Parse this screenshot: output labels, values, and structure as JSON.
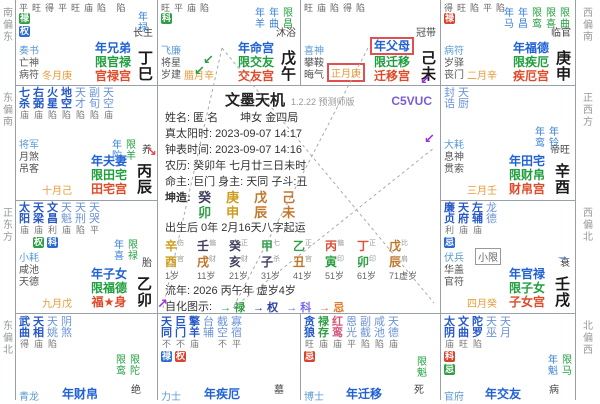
{
  "colors": {
    "main_star": "#2458c8",
    "minor_star": "#6b93d6",
    "lucun_green": "#2f9e44",
    "badge_birth": "#d9432b",
    "badge_decade": "#2f9e44",
    "badge_flow": "#2a6bd4",
    "year_name": "#2061d6",
    "limit_name": "#1f9e3e",
    "natal_name": "#e04a28",
    "month_orange": "#e89a35",
    "highlight_box": "#e05050",
    "code_purple": "#7a5cd6"
  },
  "compass": {
    "left": [
      "南偏东",
      "东偏南",
      "正东方",
      "东偏北"
    ],
    "right": [
      "西偏南",
      "正西方",
      "西偏北",
      "北偏西"
    ]
  },
  "center": {
    "title": "文墨天机",
    "version": "1.2.22 预测师版",
    "code": "C5VUC",
    "lines": {
      "name": "姓名: 匿 名　　坤女 金四局",
      "true_solar": "真太阳时: 2023-09-07 14:17",
      "clock_time": "钟表时间: 2023-09-07 14:16",
      "lunar": "农历: 癸卯年 七月廿三日未时",
      "lords": "命主: 巨门 身主: 天同 子斗:丑",
      "bazi_label": "坤造:",
      "qiyun": "出生后 0年 2月16天八字起运",
      "liunian": "流年: 2026 丙午年 虚岁4岁",
      "zihua_label": "自化图示:"
    },
    "bazi": [
      {
        "stem": "癸",
        "branch": "卯",
        "stem_el": "water",
        "branch_el": "wood"
      },
      {
        "stem": "庚",
        "branch": "申",
        "stem_el": "metal",
        "branch_el": "metal"
      },
      {
        "stem": "戊",
        "branch": "辰",
        "stem_el": "earth",
        "branch_el": "earth"
      },
      {
        "stem": "己",
        "branch": "未",
        "stem_el": "earth",
        "branch_el": "earth"
      }
    ],
    "dayun": [
      {
        "stem": "辛",
        "branch": "酉",
        "god": "伤官",
        "age": "1岁",
        "stem_el": "metal",
        "branch_el": "metal"
      },
      {
        "stem": "壬",
        "branch": "戌",
        "god": "偏财",
        "age": "11岁",
        "stem_el": "water",
        "branch_el": "earth"
      },
      {
        "stem": "癸",
        "branch": "亥",
        "god": "正财",
        "age": "21岁",
        "stem_el": "water",
        "branch_el": "water"
      },
      {
        "stem": "甲",
        "branch": "子",
        "god": "七杀",
        "age": "31岁",
        "stem_el": "wood",
        "branch_el": "water"
      },
      {
        "stem": "乙",
        "branch": "丑",
        "god": "正官",
        "age": "41岁",
        "stem_el": "wood",
        "branch_el": "earth"
      },
      {
        "stem": "丙",
        "branch": "寅",
        "god": "偏印",
        "age": "51岁",
        "stem_el": "fire",
        "branch_el": "wood"
      },
      {
        "stem": "丁",
        "branch": "卯",
        "god": "正印",
        "age": "61岁",
        "stem_el": "fire",
        "branch_el": "wood"
      },
      {
        "stem": "戊",
        "branch": "辰",
        "god": "比肩",
        "age": "71虚岁",
        "stem_el": "earth",
        "branch_el": "earth"
      }
    ],
    "zihua": [
      {
        "label": "→ 禄",
        "color": "#2f9e44"
      },
      {
        "label": "→ 权",
        "color": "#2c3ea0"
      },
      {
        "label": "→ 科",
        "color": "#7b68ee"
      },
      {
        "label": "→ 忌",
        "color": "#e07a2c"
      }
    ]
  },
  "palaces": {
    "si": {
      "branch": "巳",
      "stem": "丁巳",
      "stage": "长生",
      "month": "冬月庚",
      "gods": [
        "奏书",
        "亡神",
        "病符"
      ],
      "names": [
        "年兄弟",
        "限官禄",
        "官禄宫"
      ],
      "bri": "平旺得平旺庙陷 陷",
      "badges": [
        [
          "禄",
          "d"
        ],
        [
          "权",
          "f"
        ]
      ],
      "flows": [
        [
          "年禄",
          "year"
        ]
      ]
    },
    "wu": {
      "branch": "午",
      "stem": "戊午",
      "stage": "沐浴",
      "month": "腊月辛",
      "gods": [
        "飞廉",
        "将星",
        "岁建"
      ],
      "names": [
        "年命宫",
        "限交友",
        "交友宫"
      ],
      "bri": "旺平庙陷",
      "badges": [
        [
          "科",
          "d"
        ]
      ],
      "flows": [
        [
          "年羊",
          "year"
        ],
        [
          "年曲",
          "year"
        ],
        [
          "限昌",
          "limit"
        ]
      ]
    },
    "wei": {
      "branch": "未",
      "stem": "己未",
      "stage": "冠带",
      "month": "正月庚",
      "month_boxed": true,
      "gods": [
        "喜神",
        "攀鞍",
        "晦气"
      ],
      "names": [
        "年父母",
        "限迁移",
        "迁移宫"
      ],
      "name_boxed": true,
      "bri": "旺庙陷得陷",
      "badges": [],
      "flows": []
    },
    "shen": {
      "branch": "申",
      "stem": "庚申",
      "stage": "临官",
      "month": "二月辛",
      "gods": [
        "病符",
        "岁驿",
        "丧门"
      ],
      "names": [
        "年福德",
        "限疾厄",
        "疾厄宫"
      ],
      "bri": "得旺陷平陷",
      "badges": [
        [
          "禄",
          "y"
        ]
      ],
      "flows": [
        [
          "年马",
          "year"
        ],
        [
          "年昌",
          "year"
        ],
        [
          "限鸾",
          "limit"
        ],
        [
          "限喜",
          "limit"
        ],
        [
          "限曲",
          "limit"
        ]
      ]
    },
    "you": {
      "branch": "酉",
      "stem": "辛酉",
      "stage": "帝旺",
      "month": "三月壬",
      "gods": [
        "大耗",
        "息神",
        "贯索"
      ],
      "names": [
        "年田宅",
        "限财帛",
        "财帛宫"
      ],
      "stars": [
        {
          "n": "封诰",
          "b": "",
          "c": "mi"
        },
        {
          "n": "天厨",
          "b": "",
          "c": "mi"
        }
      ],
      "flows": [
        [
          "年鸾",
          "year"
        ],
        [
          "年铃",
          "year"
        ]
      ]
    },
    "xu": {
      "branch": "戌",
      "stem": "壬戌",
      "stage": "衰",
      "month": "四月癸",
      "gods": [
        "伏兵",
        "华盖",
        "官符"
      ],
      "names": [
        "年官禄",
        "限子女",
        "子女宫"
      ],
      "stars": [
        {
          "n": "廉贞",
          "b": "利",
          "c": "m",
          "bd": [
            [
              "忌",
              "f"
            ]
          ]
        },
        {
          "n": "天府",
          "b": "庙",
          "c": "m"
        },
        {
          "n": "左辅",
          "b": "庙",
          "c": "m"
        },
        {
          "n": "龙德",
          "b": "",
          "c": "mi"
        }
      ],
      "xiaoxian": "小限",
      "flows": []
    },
    "hai": {
      "branch": "亥",
      "stage": "病",
      "gods": [
        "官府"
      ],
      "names": [
        "年交友"
      ],
      "stars": [
        {
          "n": "太阴",
          "b": "庙",
          "c": "m",
          "bd": [
            [
              "科",
              "y"
            ],
            [
              "忌",
              "d"
            ]
          ]
        },
        {
          "n": "文曲",
          "b": "旺",
          "c": "m"
        },
        {
          "n": "陀罗",
          "b": "陷",
          "c": "m"
        },
        {
          "n": "天巫",
          "b": "",
          "c": "mi"
        },
        {
          "n": "天月",
          "b": "",
          "c": "mi"
        }
      ],
      "flows": [
        [
          "年魁",
          "year"
        ],
        [
          "限马",
          "limit"
        ]
      ]
    },
    "zi": {
      "branch": "子",
      "stage": "死",
      "gods": [
        "博士"
      ],
      "names": [
        "年迁移"
      ],
      "stars": [
        {
          "n": "贪狼",
          "b": "旺",
          "c": "m",
          "bd": [
            [
              "忌",
              "y"
            ]
          ]
        },
        {
          "n": "禄存",
          "b": "庙",
          "c": "lucun"
        },
        {
          "n": "红鸾",
          "b": "庙",
          "c": "hong"
        },
        {
          "n": "恩光",
          "b": "平",
          "c": "mi"
        },
        {
          "n": "副截",
          "b": "陷",
          "c": "mi"
        },
        {
          "n": "咸池",
          "b": "陷",
          "c": "mi"
        },
        {
          "n": "天德",
          "b": "庙",
          "c": "mi"
        }
      ],
      "flows": [
        [
          "限魁",
          "limit"
        ]
      ]
    },
    "chou": {
      "branch": "丑",
      "stage": "墓",
      "gods": [
        "力士"
      ],
      "names": [
        "年疾厄"
      ],
      "stars": [
        {
          "n": "天同",
          "b": "不",
          "c": "m",
          "bd": [
            [
              "禄",
              "f"
            ]
          ]
        },
        {
          "n": "巨门",
          "b": "不",
          "c": "m",
          "bd": [
            [
              "权",
              "y"
            ]
          ]
        },
        {
          "n": "擎羊",
          "b": "庙",
          "c": "m"
        },
        {
          "n": "台辅",
          "b": "",
          "c": "mi"
        },
        {
          "n": "截空",
          "b": "不",
          "c": "mi"
        },
        {
          "n": "寡宿",
          "b": "平",
          "c": "mi"
        }
      ],
      "flows": []
    },
    "yin": {
      "branch": "寅",
      "stage": "绝",
      "gods": [
        "青龙"
      ],
      "names": [
        "年财帛"
      ],
      "stars": [
        {
          "n": "武曲",
          "b": "得",
          "c": "m"
        },
        {
          "n": "天相",
          "b": "庙",
          "c": "m"
        },
        {
          "n": "天姚",
          "b": "陷",
          "c": "mi"
        },
        {
          "n": "阴煞",
          "b": "",
          "c": "mi"
        }
      ],
      "flows": [
        [
          "限鸾",
          "limit"
        ],
        [
          "限陀",
          "limit"
        ]
      ]
    },
    "mao": {
      "branch": "卯",
      "stem": "乙卯",
      "stage": "胎",
      "month": "九月戊",
      "gods": [
        "小耗",
        "咸池",
        "天德"
      ],
      "names": [
        "年子女",
        "限福德",
        "福★身"
      ],
      "stars": [
        {
          "n": "太阳",
          "b": "庙",
          "c": "m"
        },
        {
          "n": "天梁",
          "b": "庙",
          "c": "m",
          "bd": [
            [
              "权",
              "d"
            ]
          ]
        },
        {
          "n": "文昌",
          "b": "利",
          "c": "m",
          "bd": [
            [
              "科",
              "f"
            ]
          ]
        },
        {
          "n": "天魁",
          "b": "庙",
          "c": "mi"
        },
        {
          "n": "天刑",
          "b": "陷",
          "c": "mi"
        },
        {
          "n": "天哭",
          "b": "平",
          "c": "mi"
        }
      ],
      "flows": [
        [
          "年喜",
          "year"
        ],
        [
          "限禄",
          "limit"
        ]
      ]
    },
    "chen": {
      "branch": "辰",
      "stem": "丙辰",
      "stage": "养",
      "month": "十月己",
      "gods": [
        "将军",
        "月煞",
        "吊客"
      ],
      "names": [
        "年夫妻",
        "限田宅",
        "田宅宫"
      ],
      "stars": [
        {
          "n": "七杀",
          "b": "庙",
          "c": "m"
        },
        {
          "n": "右弼",
          "b": "庙",
          "c": "m"
        },
        {
          "n": "火星",
          "b": "陷",
          "c": "m"
        },
        {
          "n": "地空",
          "b": "陷",
          "c": "m"
        },
        {
          "n": "天才",
          "b": "陷",
          "c": "mi"
        },
        {
          "n": "副旬",
          "b": "陷",
          "c": "mi"
        },
        {
          "n": "天空",
          "b": "庙",
          "c": "mi"
        }
      ],
      "flows": [
        [
          "年陀",
          "year"
        ],
        [
          "限羊",
          "limit"
        ]
      ]
    }
  }
}
